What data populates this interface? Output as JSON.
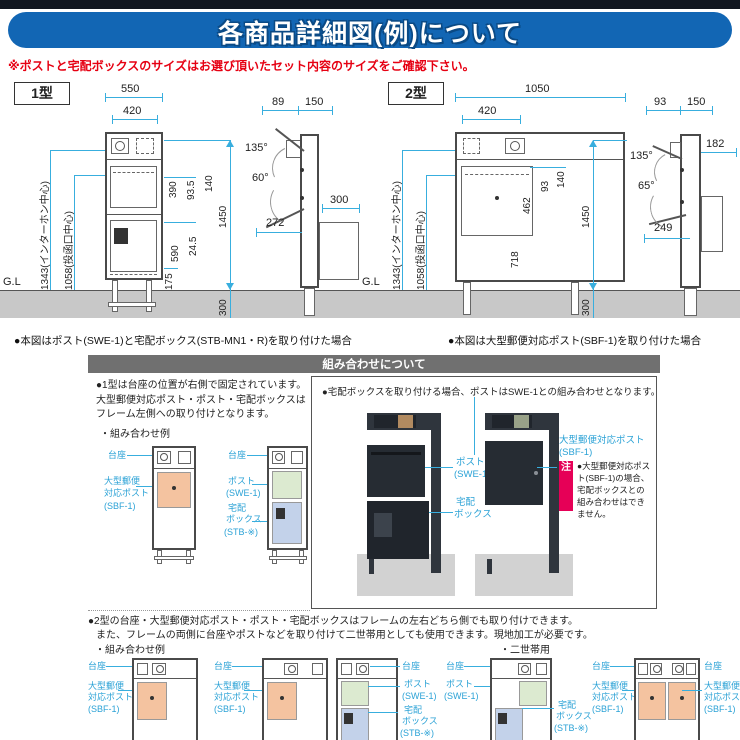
{
  "header": {
    "title": "各商品詳細図(例)について",
    "warning": "※ポストと宅配ボックスのサイズはお選び頂いたセット内容のサイズをご確認下さい。"
  },
  "type1": {
    "badge": "1型",
    "caption": "●本図はポスト(SWE-1)と宅配ボックス(STB-MN1・R)を取り付けた場合",
    "front": {
      "w_outer": "550",
      "w_inner": "420",
      "d1": "390",
      "d2": "93.5",
      "d3": "140",
      "d4": "590",
      "d5": "24.5",
      "d6": "175",
      "h_total": "1450",
      "h_below": "300",
      "label_intercom": "1343(インターホン中心)",
      "label_slot": "1058(投函口中心)",
      "gl": "G.L"
    },
    "side": {
      "d_top1": "89",
      "d_top2": "150",
      "angle1": "135°",
      "angle2": "60°",
      "d_depth": "300",
      "d_open": "272"
    }
  },
  "type2": {
    "badge": "2型",
    "caption": "●本図は大型郵便対応ポスト(SBF-1)を取り付けた場合",
    "front": {
      "w_outer": "1050",
      "w_inner": "420",
      "d1": "462",
      "d2": "93",
      "d3": "140",
      "d4": "718",
      "h_total": "1450",
      "h_below": "300",
      "label_intercom": "1343(インターホン中心)",
      "label_slot": "1058(投函口中心)",
      "gl": "G.L"
    },
    "side": {
      "d_top1": "93",
      "d_top2": "150",
      "d_right": "182",
      "angle1": "135°",
      "angle2": "65°",
      "d_open": "249"
    }
  },
  "combo": {
    "header": "組み合わせについて",
    "left_note": "●1型は台座の位置が右側で固定されています。大型郵便対応ポスト・ポスト・宅配ボックスはフレーム左側への取り付けとなります。",
    "example_label": "・組み合わせ例",
    "right_note": "●宅配ボックスを取り付ける場合、ポストはSWE-1との組み合わせとなります。",
    "note_badge": "注",
    "note_text": "●大型郵便対応ポスト(SBF-1)の場合、宅配ボックスとの組み合わせはできません。"
  },
  "labels": {
    "daiza": "台座",
    "ohgata1": "大型郵便",
    "ohgata2": "対応ポスト",
    "ohgata_full": "大型郵便対応ポスト",
    "sbf": "(SBF-1)",
    "post": "ポスト",
    "swe": "(SWE-1)",
    "takuhai1": "宅配",
    "takuhai2": "ボックス",
    "takuhai_full": "宅配ボックス",
    "stb": "(STB-※)"
  },
  "bottom": {
    "note_line1": "●2型の台座・大型郵便対応ポスト・ポスト・宅配ボックスはフレームの左右どちら側でも取り付けできます。",
    "note_line2": "また、フレームの両側に台座やポストなどを取り付けて二世帯用としても使用できます。現地加工が必要です。",
    "example_label": "・組み合わせ例",
    "dual_label": "・二世帯用"
  }
}
